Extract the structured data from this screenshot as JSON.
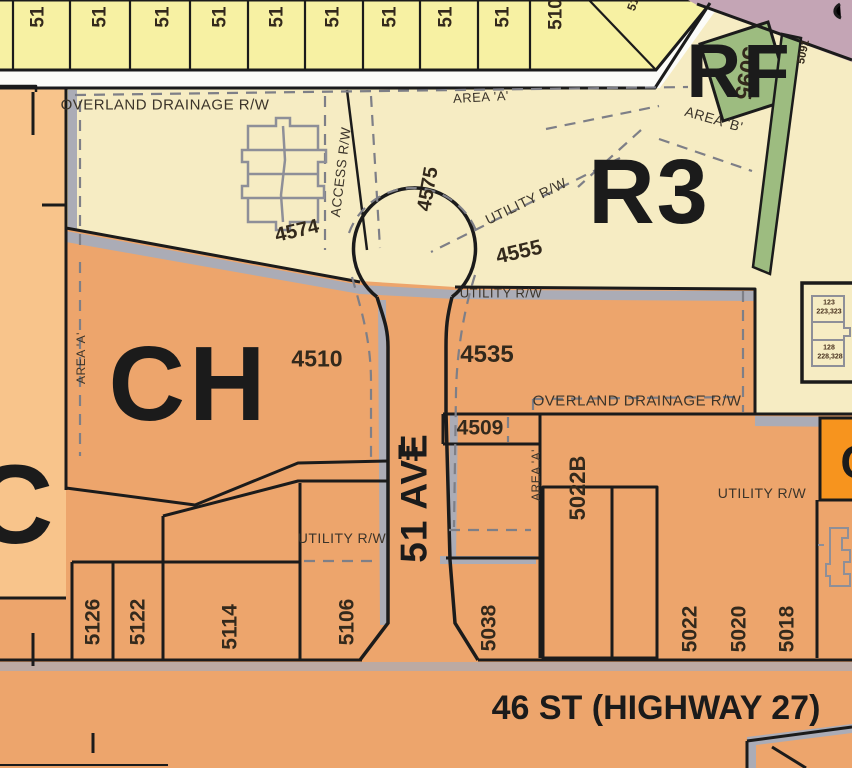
{
  "map": {
    "title": "zoning-parcel-map",
    "zones": {
      "ch": "CH",
      "r3": "R3",
      "rf": "RF",
      "c": "C",
      "c_cut": "C"
    },
    "roads": {
      "vertical": "51 AVE",
      "horizontal": "46 ST (HIGHWAY 27)"
    },
    "labels": {
      "lot_51": "51",
      "lot_510": "510",
      "lot_51_cut": "51",
      "overland_rw": "OVERLAND DRAINAGE R/W",
      "area_a": "AREA 'A'",
      "area_b": "AREA 'B'",
      "utility_rw": "UTILITY R/W",
      "access_rw": "ACCESS R/W",
      "n4574": "4574",
      "n4575": "4575",
      "n4555": "4555",
      "n5095": "5095",
      "n5091": "5091",
      "n4510": "4510",
      "n4535": "4535",
      "n4509": "4509",
      "n5022b": "5022B",
      "n5126": "5126",
      "n5122": "5122",
      "n5114": "5114",
      "n5106": "5106",
      "n5038": "5038",
      "n5022": "5022",
      "n5020": "5020",
      "n5018": "5018",
      "bldg_unit_top_a": "123",
      "bldg_unit_top_b": "223,323",
      "bldg_unit_bot_a": "128",
      "bldg_unit_bot_b": "228,328"
    },
    "colors": {
      "zone_orange": "#EDA56C",
      "zone_cream": "#F6ECC3",
      "zone_yellow": "#F7F1A3",
      "zone_green": "#9DBC80",
      "zone_mauve": "#C4A5B5",
      "zone_light_orange": "#F8C48B",
      "zone_bright_orange": "#F7941E",
      "road_gray": "#ABACB6",
      "line_black": "#1b1b1b",
      "dash_gray": "#7e7f87"
    }
  }
}
